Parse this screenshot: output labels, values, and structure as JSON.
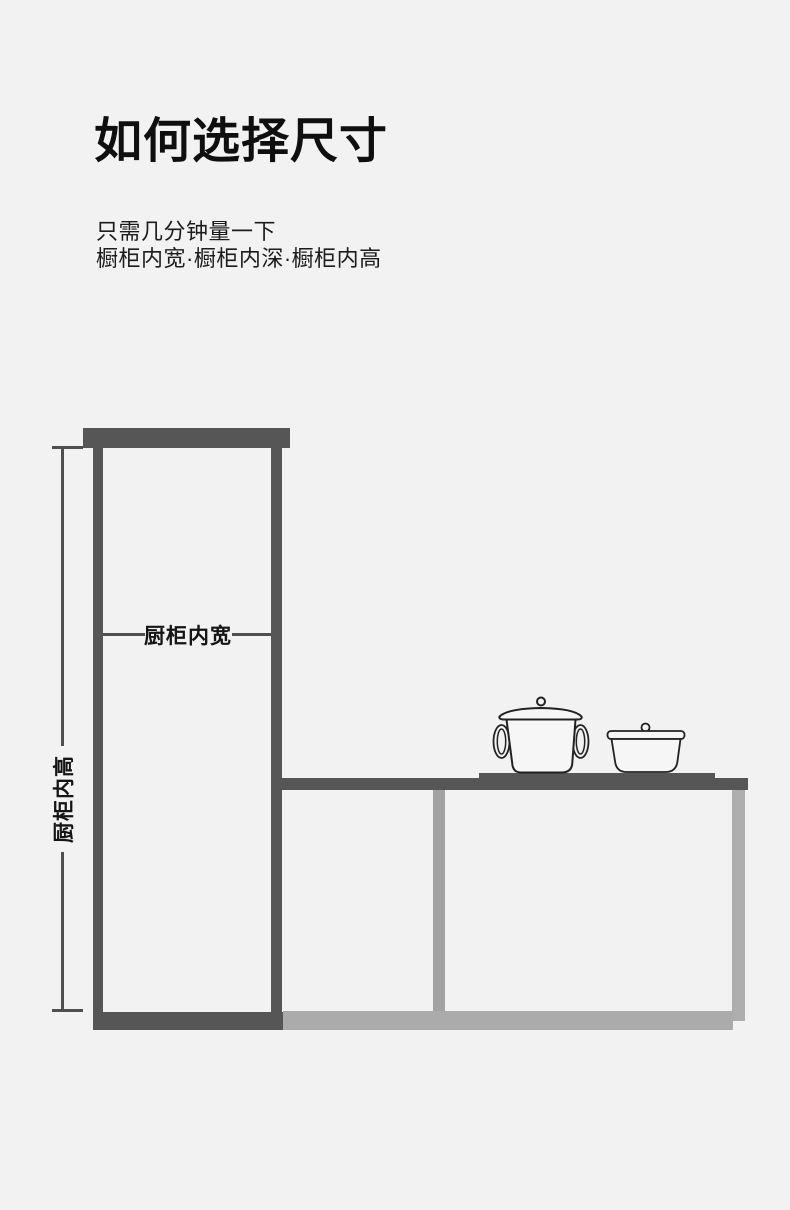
{
  "page": {
    "background_color": "#f1f2f1"
  },
  "header": {
    "title": "如何选择尺寸",
    "subtitle_lines": [
      "只需几分钟量一下",
      "橱柜内宽·橱柜内深·橱柜内高"
    ]
  },
  "diagram": {
    "width_label": "厨柜内宽",
    "height_label": "厨柜内高",
    "colors": {
      "cabinet_dark": "#565657",
      "divider_gray": "#a2a2a2",
      "panel_light_gray": "#aeaeae",
      "bottom_bar_light": "#ababab",
      "dimension_line": "#4f4f4f",
      "label_text": "#151515",
      "pot_outline": "#222222",
      "pot_fill": "#f6f6f6"
    },
    "icons": [
      "pot-large-icon",
      "pot-small-icon"
    ]
  }
}
